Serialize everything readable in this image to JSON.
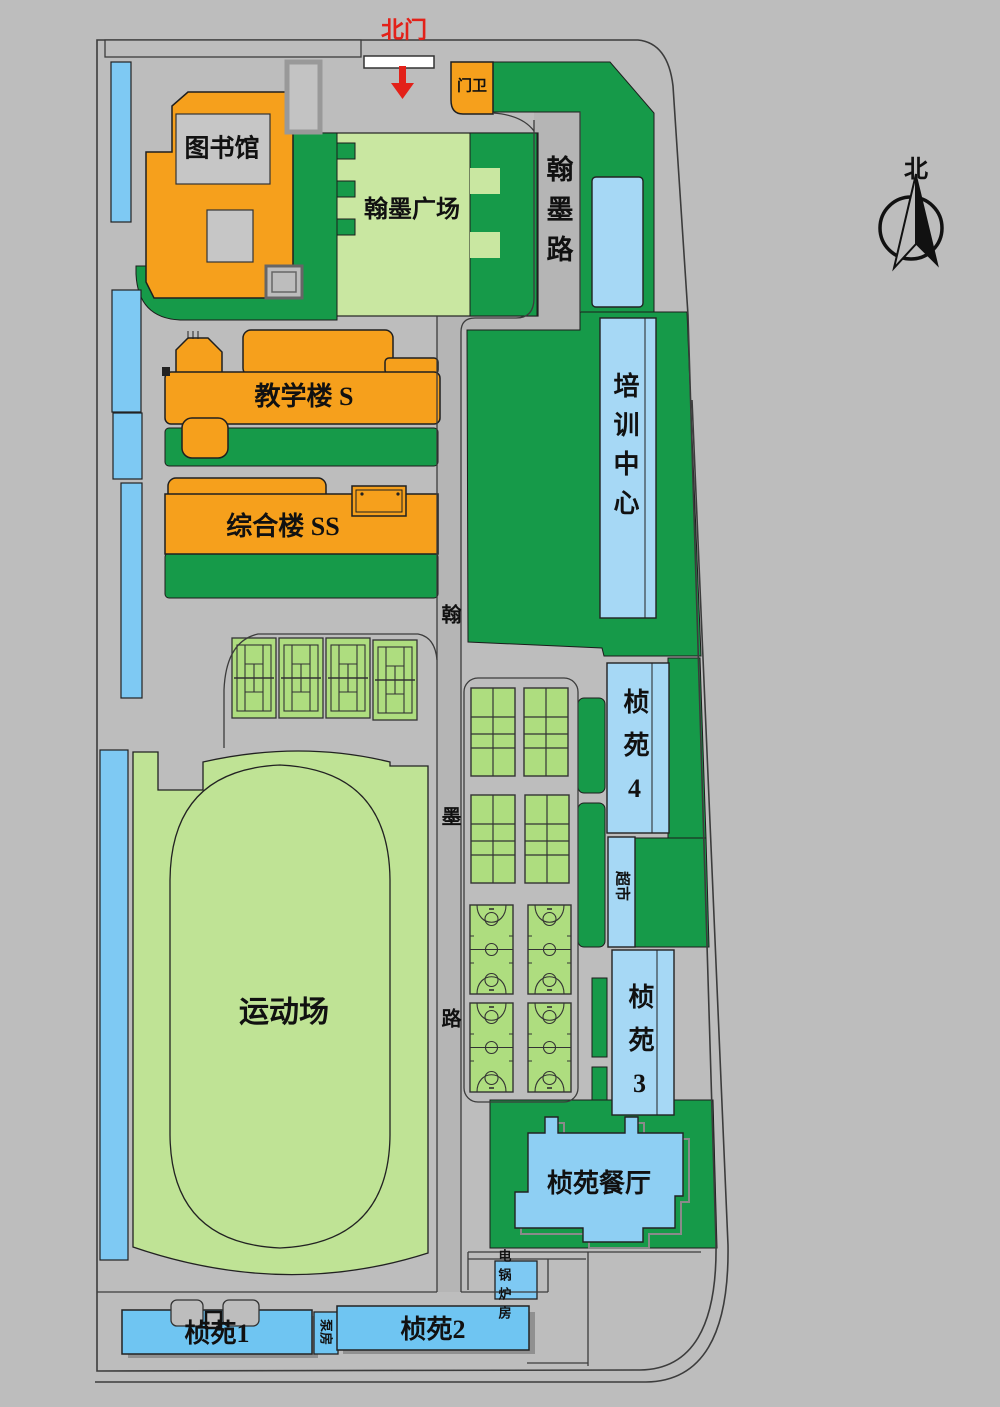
{
  "labels": {
    "north_gate": "北门",
    "guard_house": "门卫",
    "library": "图书馆",
    "plaza": "翰墨广场",
    "road_hanmo_east": "翰墨路",
    "road_hanmo_center": "翰墨路",
    "teaching_building": "教学楼 S",
    "comprehensive_building": "综合楼 SS",
    "training_center": "培训中心",
    "zhenyuan_4": "桢苑4",
    "supermarket": "超市",
    "zhenyuan_3": "桢苑3",
    "dining_hall": "桢苑餐厅",
    "sports_field": "运动场",
    "zhenyuan_1": "桢苑1",
    "pump_room": "泵房",
    "zhenyuan_2": "桢苑2",
    "boiler_room": "电锅炉房",
    "compass_north": "北"
  },
  "colors": {
    "background_gray": "#bdbdbd",
    "road_gray": "#b5b5b5",
    "lawn_green": "#169a49",
    "plaza_green": "#c9e7a1",
    "field_green": "#bfe395",
    "court_green": "#aedd7f",
    "building_orange": "#f6a01c",
    "building_blue": "#7ec9f3",
    "building_blue_light": "#a6d8f5",
    "building_blue_deep": "#6fc5f2",
    "gate_red": "#e32119",
    "outline_dark": "#3c3c3c"
  }
}
